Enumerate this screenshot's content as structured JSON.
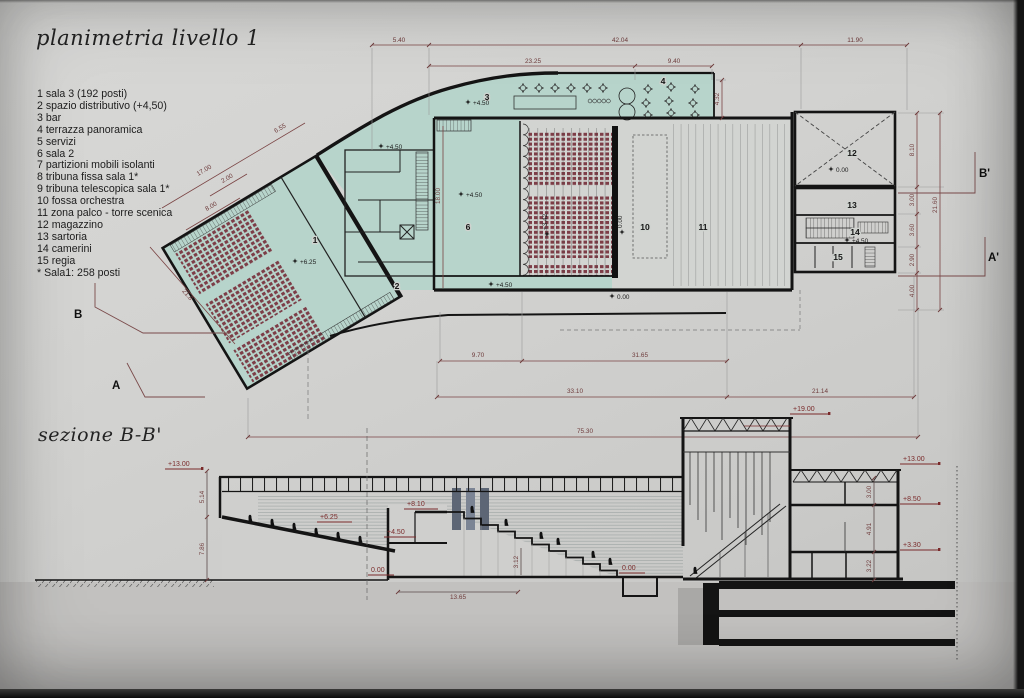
{
  "titles": {
    "plan": "planimetria livello 1",
    "section": "sezione B-B'"
  },
  "legend": [
    "1 sala 3 (192 posti)",
    "2 spazio distributivo (+4,50)",
    "3 bar",
    "4 terrazza panoramica",
    "5 servizi",
    "6 sala 2",
    "7 partizioni mobili isolanti",
    "8 tribuna fissa sala 1*",
    "9 tribuna telescopica sala 1*",
    "10 fossa orchestra",
    "11 zona palco - torre scenica",
    "12 magazzino",
    "13 sartoria",
    "14 camerini",
    "15 regia",
    "* Sala1: 258 posti"
  ],
  "colors": {
    "teal": "#b7d4cb",
    "seat_red": "#7d3d47",
    "dim_red": "#7a4343",
    "label_red": "#7a2a2a"
  },
  "plan": {
    "dims": {
      "top1": "5.40",
      "top2": "42.04",
      "top3": "11.90",
      "mid1": "23.25",
      "mid2": "9.40",
      "v432": "4.32",
      "r17": "17.00",
      "r655": "6.55",
      "r200": "2.00",
      "r800": "8.00",
      "v1800": "18.00",
      "diag218": "21.8",
      "rv810": "8.10",
      "rv300": "3.00",
      "rv360": "3.60",
      "rv290": "2.90",
      "rv400": "4.00",
      "rvtot": "21.60",
      "b970": "9.70",
      "b3165": "31.65",
      "b3310": "33.10",
      "b2114": "21.14",
      "b7530": "75.30"
    },
    "rooms": {
      "r1": "1",
      "r2": "2",
      "r3": "3",
      "r4": "4",
      "r6": "6",
      "r10": "10",
      "r11": "11",
      "r12": "12",
      "r13": "13",
      "r14": "14",
      "r15": "15"
    },
    "levels": {
      "s450a": "+4.50",
      "s450b": "+4.50",
      "s450c": "+4.50",
      "s450d": "+4.50",
      "s450e": "+4.50",
      "s625": "+6.25",
      "z000a": "0.00",
      "z000b": "0.00",
      "rot342": "+3.42",
      "rot000": "0.00"
    },
    "sections": {
      "A": "A",
      "B": "B",
      "A1": "A'",
      "B1": "B'"
    }
  },
  "section": {
    "levels": {
      "l13l": "+13.00",
      "l625": "+6.25",
      "l810": "+8.10",
      "l450": "+4.50",
      "l000a": "0.00",
      "l000b": "0.00",
      "l1900": "+19.00",
      "l13r": "+13.00",
      "l850": "+8.50",
      "l330": "+3.30"
    },
    "dims": {
      "d514": "5.14",
      "d786": "7.86",
      "d1365": "13.65",
      "d312": "3.12",
      "d300": "3.00",
      "d491": "4.91",
      "d322": "3.22"
    }
  }
}
